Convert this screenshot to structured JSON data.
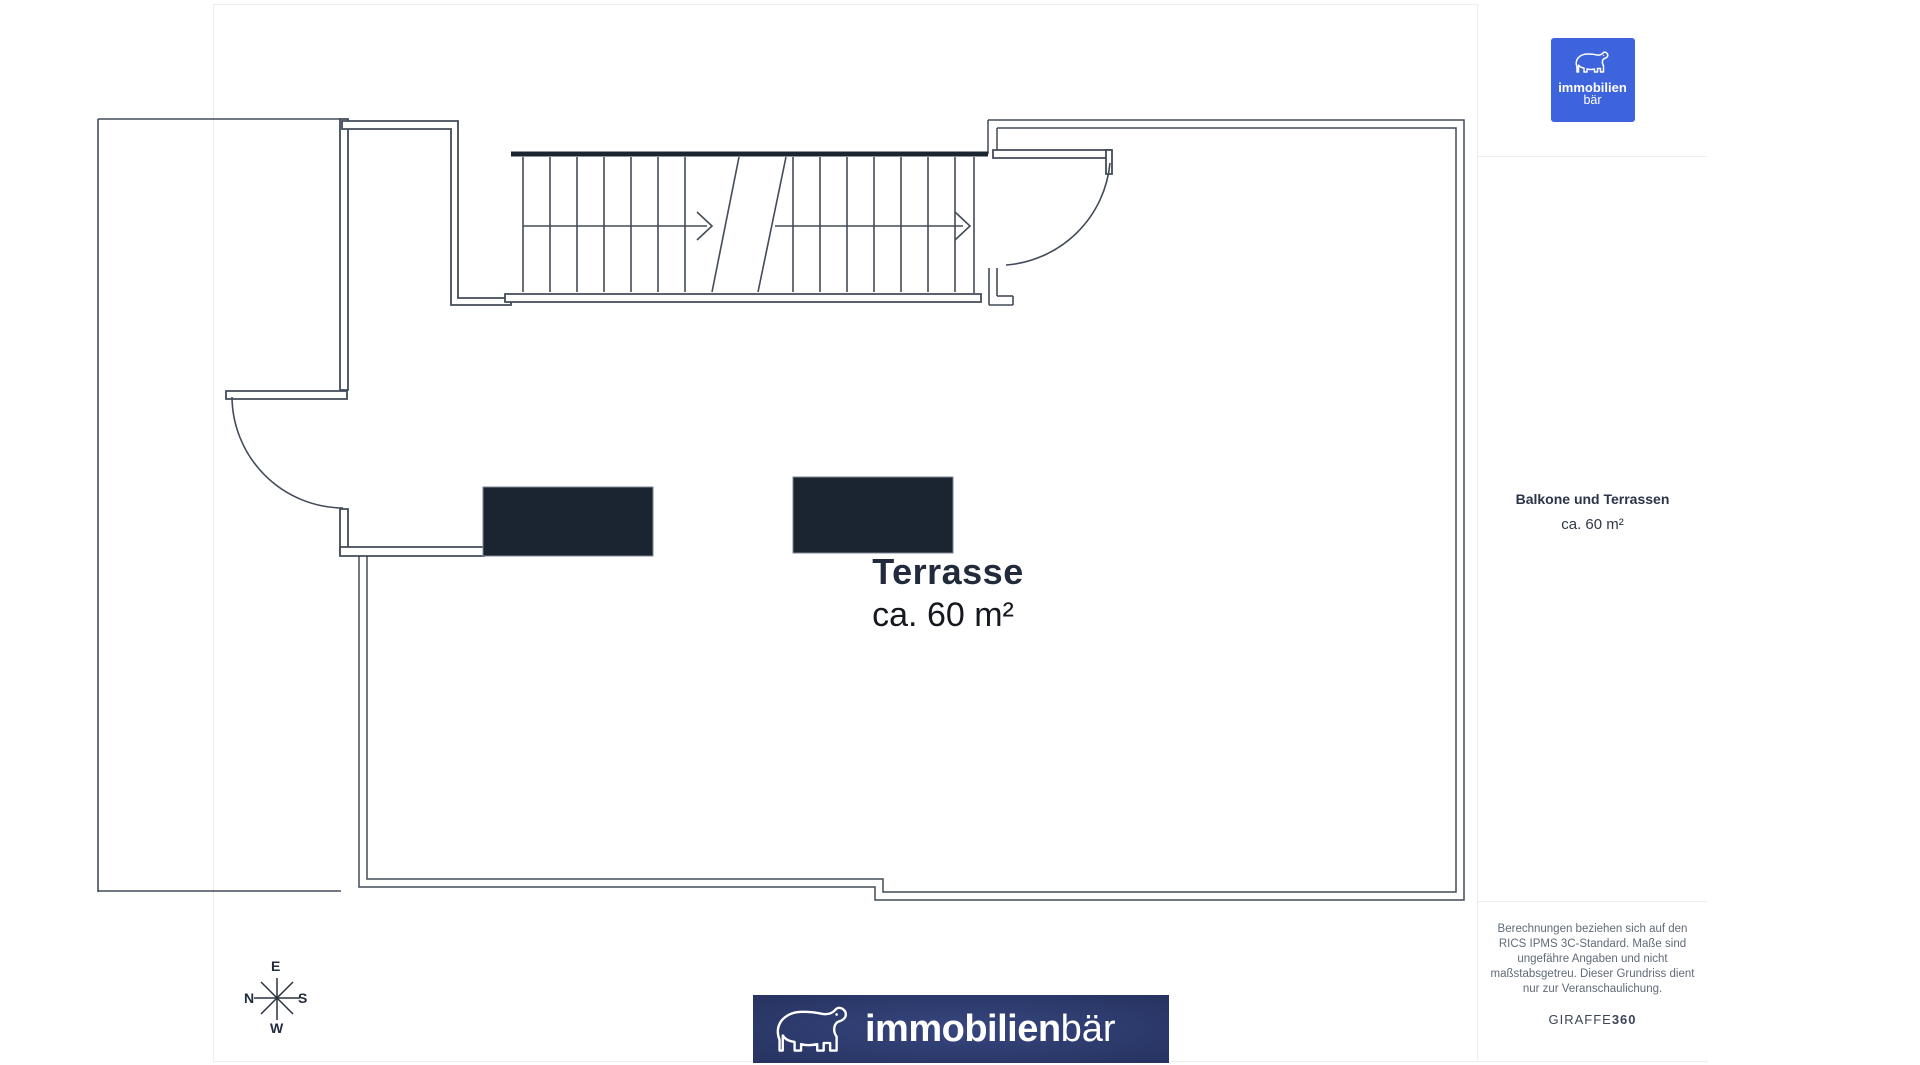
{
  "plan": {
    "room": {
      "label": "Terrasse",
      "area": "ca. 60 m²"
    },
    "compass": {
      "top": "E",
      "left": "N",
      "right": "S",
      "bottom": "W"
    }
  },
  "sidebar": {
    "logo": {
      "line1": "immobilien",
      "line2": "bär"
    },
    "summary": {
      "title": "Balkone und Terrassen",
      "area": "ca. 60 m²"
    },
    "disclaimer": {
      "text": "Berechnungen beziehen sich auf den RICS IPMS 3C-Standard. Maße sind ungefähre Angaben und nicht maßstabsgetreu. Dieser Grundriss dient nur zur Veranschaulichung."
    },
    "brand": {
      "name": "GIRAFFE",
      "suffix": "360"
    }
  },
  "footer": {
    "logo_bold": "immobilien",
    "logo_light": "bär"
  },
  "colors": {
    "accent_blue": "#3d63dd",
    "wall_line": "#434b59",
    "dark_fill": "#1b2431",
    "banner_navy": "#2c3a6c"
  }
}
